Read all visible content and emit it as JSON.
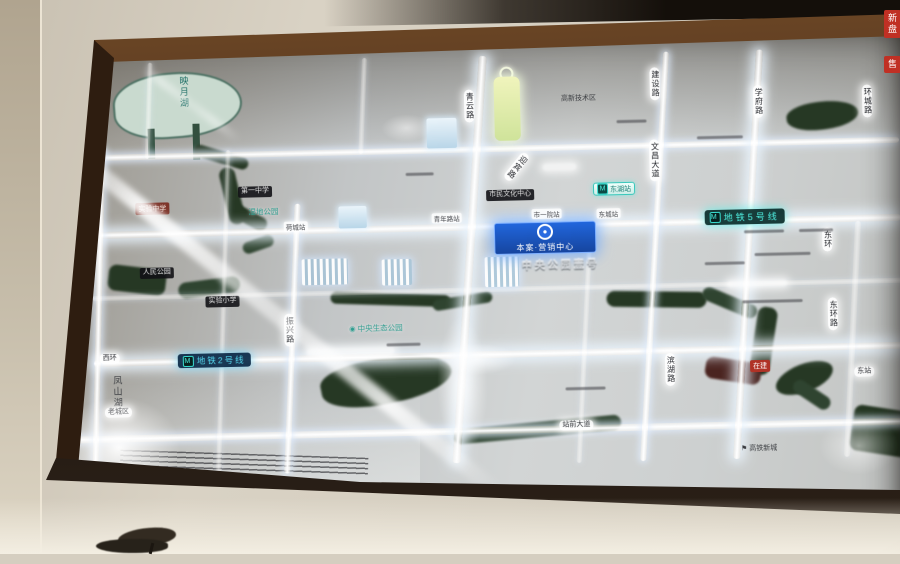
{
  "colors": {
    "metro_teal": "#4ff0e2",
    "metro_blue": "#55d8f0",
    "badge_blue": "#1f63d8",
    "water_green": "#263824",
    "lake_mint": "#c9dacf",
    "red_label": "#b03226",
    "road_glow": "#ffffff",
    "frame_brown": "#3a2310"
  },
  "icons": {
    "metro": "M",
    "park": "◉",
    "flag": "⚑",
    "project_logo": "ring-logo"
  },
  "map": {
    "lake_label": "映月湖",
    "hill_label": "凤山湖",
    "badge": {
      "title": "本案·营销中心"
    },
    "embossed_title": "中央公园壹号",
    "metro5_label": "地铁5号线",
    "metro2_label": "地铁2号线",
    "station_chip": {
      "label": "东湖站"
    },
    "stations": [
      {
        "label": "荷城站"
      },
      {
        "label": "青年路站"
      },
      {
        "label": "市一院站"
      },
      {
        "label": "东城站"
      }
    ],
    "road_pills": [
      {
        "label": "青云路"
      },
      {
        "label": "建设路"
      },
      {
        "label": "文昌大道"
      },
      {
        "label": "学府路"
      },
      {
        "label": "环城路"
      },
      {
        "label": "振兴路"
      },
      {
        "label": "滨湖路"
      },
      {
        "label": "东环路"
      },
      {
        "label": "迎宾路"
      },
      {
        "label": "东环"
      },
      {
        "label": "老城区"
      },
      {
        "label": "西环"
      },
      {
        "label": "站前大道"
      },
      {
        "label": "东站"
      }
    ],
    "pois": [
      {
        "label": "第一中学"
      },
      {
        "label": "人民公园"
      },
      {
        "label": "实验小学"
      },
      {
        "label": "市民文化中心"
      },
      {
        "label": "高新技术区"
      },
      {
        "label": "高铁新城"
      },
      {
        "label": "湿地公园"
      },
      {
        "label": "中央生态公园"
      },
      {
        "label": "实验中学"
      },
      {
        "label": "在建"
      },
      {
        "label": "新盘"
      },
      {
        "label": "售"
      }
    ]
  }
}
